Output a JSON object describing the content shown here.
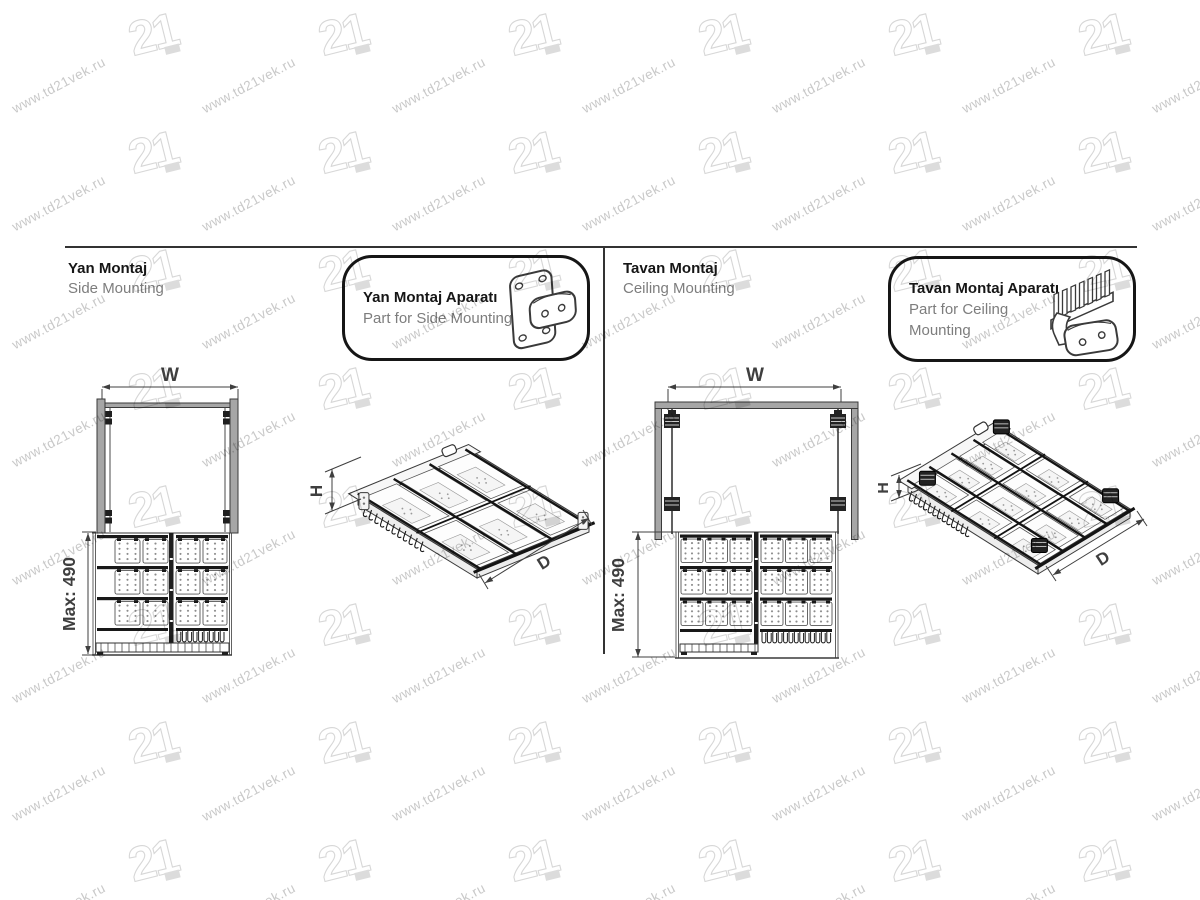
{
  "watermark": {
    "url_text": "www.td21vek.ru",
    "logo_text": "21"
  },
  "sections": {
    "side": {
      "title": "Yan Montaj",
      "subtitle": "Side Mounting",
      "callout": {
        "title": "Yan Montaj Aparatı",
        "subtitle": "Part for Side Mounting"
      },
      "dims": {
        "width": "W",
        "max_height": "Max: 490",
        "height": "H",
        "depth": "D"
      }
    },
    "ceiling": {
      "title": "Tavan Montaj",
      "subtitle": "Ceiling Mounting",
      "callout": {
        "title": "Tavan Montaj Aparatı",
        "subtitle": "Part for Ceiling Mounting"
      },
      "dims": {
        "width": "W",
        "max_height": "Max: 490",
        "height": "H",
        "depth": "D"
      }
    }
  },
  "colors": {
    "line": "#3a3a3a",
    "dark": "#1c1c1c",
    "gray_fill": "#a6a6a6",
    "title_text": "#161616",
    "subtitle_text": "#7d7d7d",
    "dim_text": "#3f3f3f",
    "watermark_text": "#c9c9c9",
    "watermark_logo": "#d7d7d7"
  }
}
